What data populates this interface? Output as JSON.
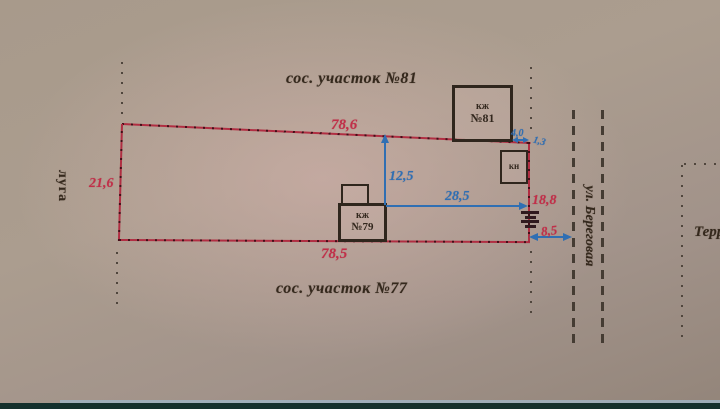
{
  "labels": {
    "neighbor_top": "сос. участок №81",
    "neighbor_bottom": "сос. участок №77",
    "meadow": "луга",
    "street": "ул. Береговая",
    "territory": "Терр"
  },
  "dimensions": {
    "top_boundary": "78,6",
    "left_boundary": "21,6",
    "bottom_boundary": "78,5",
    "right_boundary": "18,8",
    "house_to_top": "12,5",
    "house_to_street": "28,5",
    "gate_to_street": "8,5",
    "b81_to_corner": "4,0",
    "corner_offset": "1,3"
  },
  "buildings": {
    "b81": {
      "line1": "кж",
      "line2": "№81"
    },
    "b79": {
      "line1": "кж",
      "line2": "№79"
    },
    "bn": {
      "label": "кн"
    }
  },
  "colors": {
    "boundary_red": "#b02e42",
    "dimension_red": "#c22f49",
    "dimension_blue": "#2f6fb3",
    "ink_dark": "#35291d",
    "street_dash": "#453c33",
    "photo_paper": "#c7b2ab",
    "photo_edge_bar": "#14302c"
  }
}
